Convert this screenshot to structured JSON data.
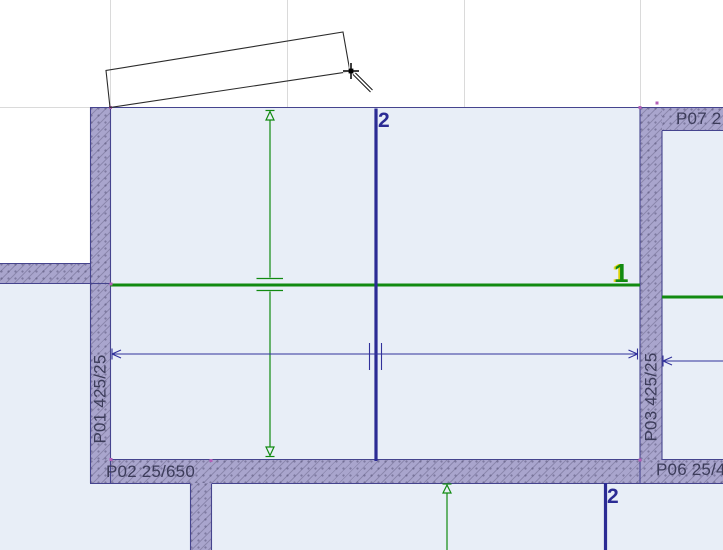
{
  "view": {
    "type": "cad-floor-plan",
    "description": "Architectural floor plan editing canvas with hatched walls, level/section markers, dimension chains and a rectangle being drawn with the crosshair cursor"
  },
  "colors": {
    "background": "#ffffff",
    "room_fill": "#e8eef7",
    "wall_fill": "#a9a5cd",
    "wall_outline": "#45448e",
    "grid_line": "#dadada",
    "level_line_green": "#118a11",
    "section_line_blue": "#2b2b94",
    "dimension_blue": "#31319b",
    "tag_text": "#3c3c5a",
    "hotspot_pink": "#b560b8",
    "sketch_outline": "#2b2b2b"
  },
  "wall_tags": {
    "left": "P01 425/25",
    "bottom_left": "P02 25/650",
    "right": "P03 425/25",
    "bottom_right": "P06 25/4",
    "top_right": "P07 2"
  },
  "markers": {
    "level_main": "1",
    "section_main": "2",
    "section_lower": "2"
  }
}
